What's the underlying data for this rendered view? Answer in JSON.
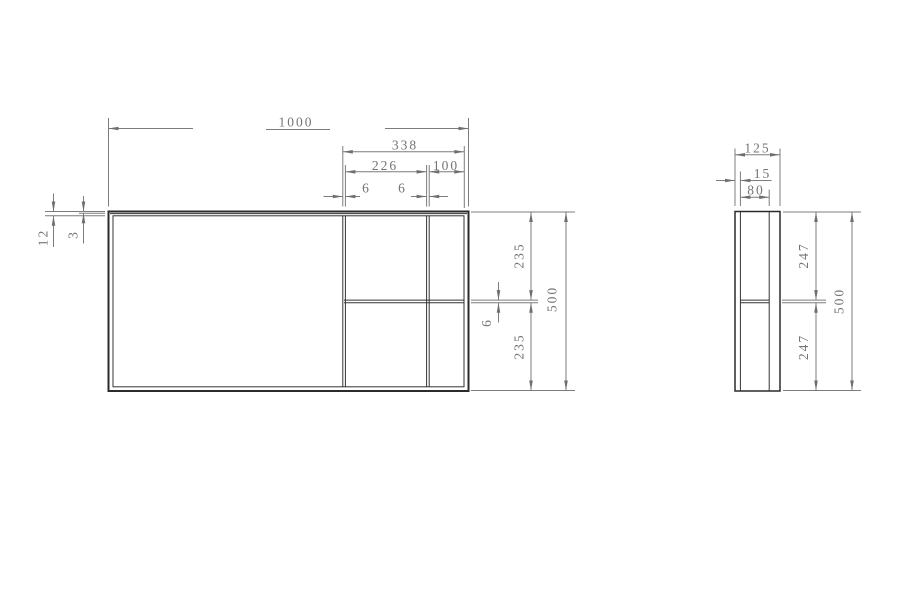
{
  "drawing": {
    "type": "cad-dimension-drawing",
    "colors": {
      "body_line": "#2b2b2b",
      "dimension_line": "#7c7c7c",
      "dimension_text": "#747474",
      "background": "#ffffff"
    },
    "front_view": {
      "dims": {
        "overall_width": "1000",
        "right_assembly_width": "338",
        "middle_opening_width": "226",
        "right_opening_width": "100",
        "mullion_thickness_left": "6",
        "mullion_thickness_right": "6",
        "frame_profile_depth": "12",
        "frame_face_offset": "3",
        "upper_opening_height": "235",
        "rail_thickness": "6",
        "lower_opening_height": "235",
        "overall_height": "500"
      }
    },
    "side_view": {
      "dims": {
        "overall_depth": "125",
        "front_lip": "15",
        "channel_opening": "80",
        "upper_section_height": "247",
        "lower_section_height": "247",
        "overall_height": "500"
      }
    }
  }
}
